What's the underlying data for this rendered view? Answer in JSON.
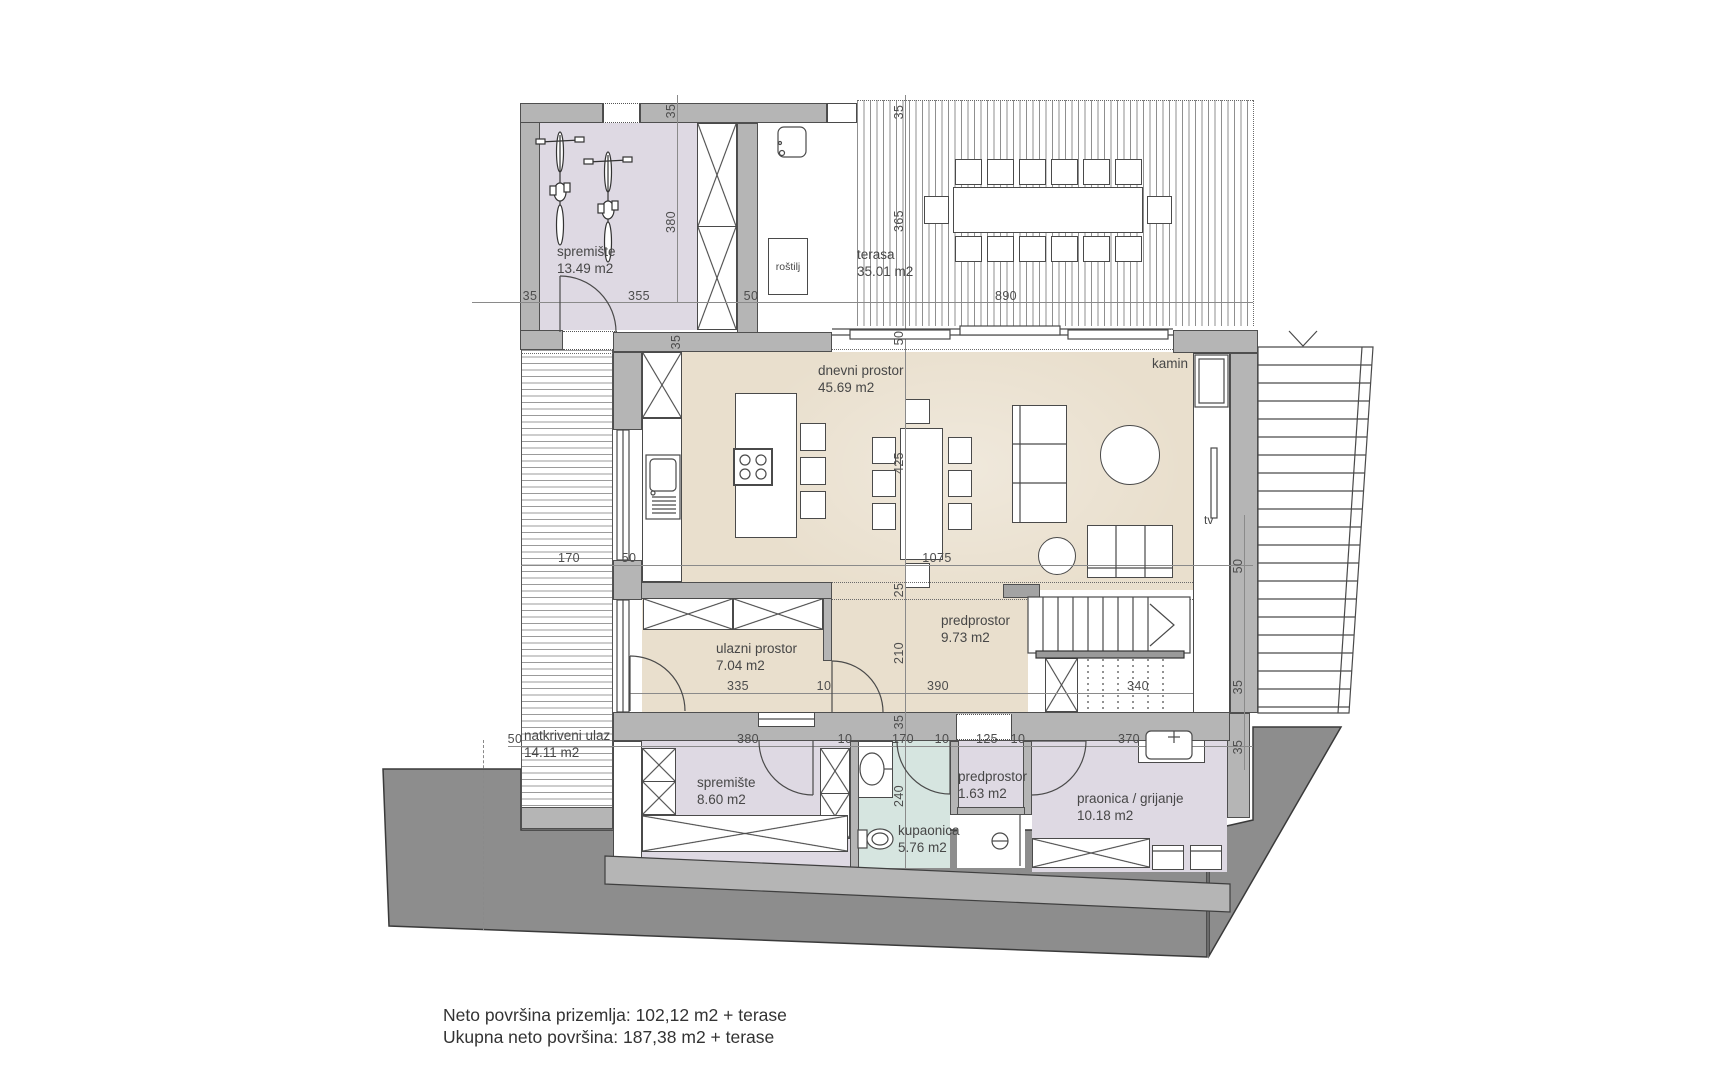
{
  "summary": {
    "line1": "Neto površina prizemlja: 102,12 m2 + terase",
    "line2": "Ukupna neto površina: 187,38 m2 + terase"
  },
  "rooms": [
    {
      "id": "spremiste-gore",
      "name": "spremište",
      "area": "13.49 m2"
    },
    {
      "id": "terasa",
      "name": "terasa",
      "area": "35.01 m2"
    },
    {
      "id": "dnevni-prostor",
      "name": "dnevni prostor",
      "area": "45.69 m2"
    },
    {
      "id": "ulazni-prostor",
      "name": "ulazni prostor",
      "area": "7.04 m2"
    },
    {
      "id": "predprostor",
      "name": "predprostor",
      "area": "9.73 m2"
    },
    {
      "id": "natkriveni-ulaz",
      "name": "natkriveni ulaz",
      "area": "14.11 m2"
    },
    {
      "id": "spremiste-dolje",
      "name": "spremište",
      "area": "8.60 m2"
    },
    {
      "id": "kupaonica",
      "name": "kupaonica",
      "area": "5.76 m2"
    },
    {
      "id": "predprostor-mali",
      "name": "predprostor",
      "area": "1.63 m2"
    },
    {
      "id": "praonica",
      "name": "praonica / grijanje",
      "area": "10.18 m2"
    }
  ],
  "features": {
    "rostilj": "roštilj",
    "kamin": "kamin",
    "tv": "tv"
  },
  "dims": [
    "35",
    "355",
    "50",
    "890",
    "35",
    "380",
    "35",
    "365",
    "35",
    "50",
    "425",
    "170",
    "50",
    "1075",
    "50",
    "25",
    "210",
    "335",
    "10",
    "390",
    "340",
    "35",
    "35",
    "50",
    "380",
    "10",
    "170",
    "10",
    "125",
    "10",
    "370",
    "35",
    "240"
  ],
  "colors": {
    "wall": "#b5b5b5",
    "living_floor": "#e9dfcd",
    "storage_floor": "#ded9e3",
    "bath_floor": "#d6e5e0",
    "terrain": "#8d8d8d",
    "line": "#4a4a4a"
  }
}
